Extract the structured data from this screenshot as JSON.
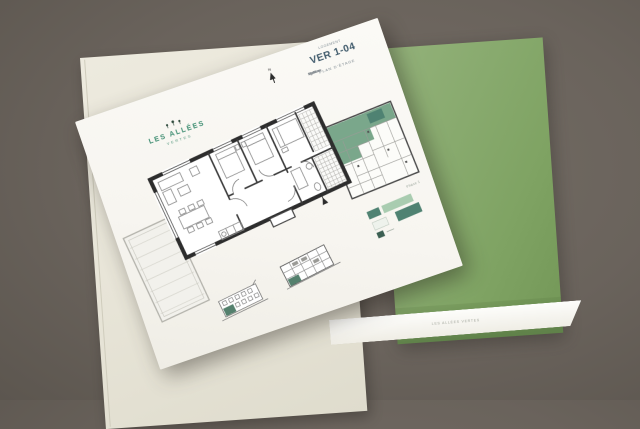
{
  "scene": {
    "background_color": "#6a635c",
    "folder_color": "#83a668",
    "booklet_color": "#e9e6da",
    "accent_teal": "#4f8272",
    "highlight_green": "#7aa78b"
  },
  "sheet": {
    "logo": {
      "name": "LES ALLÉES",
      "subtitle": "VERTES"
    },
    "north_label": "N",
    "title_block": {
      "kicker": "LOGEMENT",
      "unit": "VER 1-04",
      "rows": [
        {
          "label": "Type",
          "value": "3 pièces"
        },
        {
          "label": "Surface",
          "value": "62.35 m²"
        },
        {
          "label": "Terrasse",
          "value": "14.80 m²"
        }
      ],
      "caption": "PLAN D'ÉTAGE"
    },
    "key_plan_label": "Phase 1"
  },
  "folder": {
    "label_strip_text": "LES ALLÉES VERTES"
  }
}
